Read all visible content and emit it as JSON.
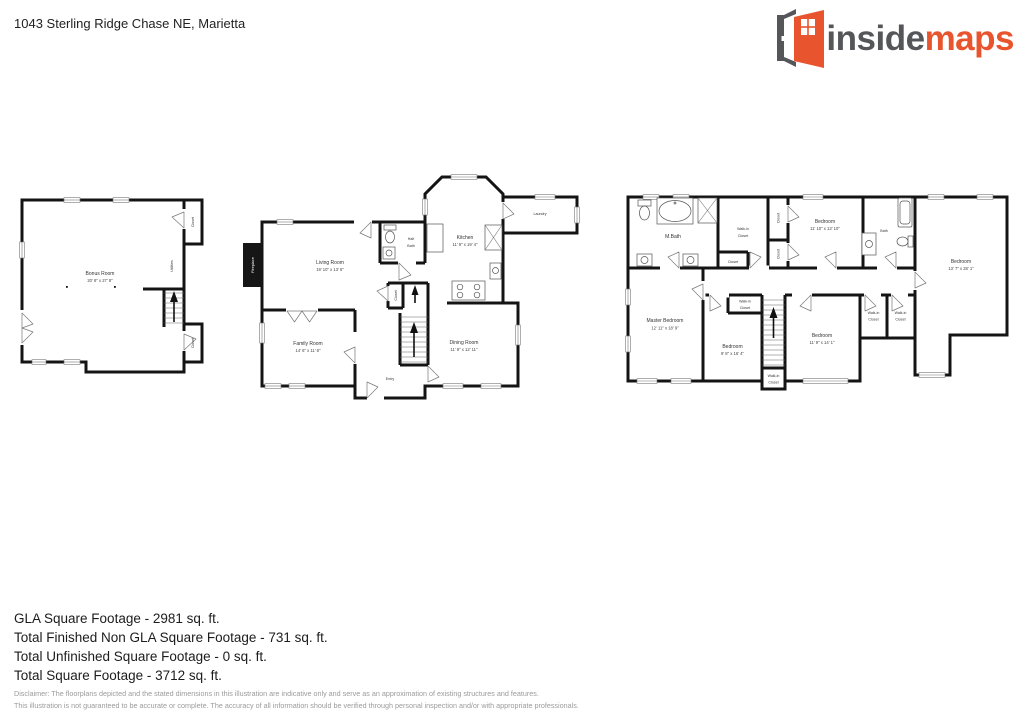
{
  "header": {
    "address": "1043 Sterling Ridge Chase NE, Marietta"
  },
  "logo": {
    "word_dark": "inside",
    "word_accent": "maps",
    "accent_color": "#e8542e",
    "dark_color": "#55565a"
  },
  "shared": {
    "closet": "Closet",
    "walk_in_line1": "Walk-in",
    "walk_in_line2": "Closet"
  },
  "floors": {
    "basement": {
      "bonus_room": {
        "name": "Bonus Room",
        "dims": "20' 8\" x 27' 8\""
      },
      "utilities": "Utilities"
    },
    "main": {
      "living_room": {
        "name": "Living Room",
        "dims": "19' 10\" x 13' 6\""
      },
      "kitchen": {
        "name": "Kitchen",
        "dims": "11' 9\" x 19' 4\""
      },
      "family_room": {
        "name": "Family Room",
        "dims": "14' 6\" x 11' 8\""
      },
      "dining_room": {
        "name": "Dining Room",
        "dims": "11' 9\" x 12' 11\""
      },
      "half_bath_line1": "Half",
      "half_bath_line2": "Bath",
      "laundry": "Laundry",
      "entry": "Entry",
      "fireplace": "Fireplace"
    },
    "upper": {
      "master_bedroom": {
        "name": "Master Bedroom",
        "dims": "12' 11\" x 18' 9\""
      },
      "m_bath": "M.Bath",
      "bath": "Bath",
      "bedroom_top": {
        "name": "Bedroom",
        "dims": "11' 10\" x 13' 10\""
      },
      "bedroom_right": {
        "name": "Bedroom",
        "dims": "13' 7\" x 28' 1\""
      },
      "bedroom_center": {
        "name": "Bedroom",
        "dims": "9' 8\" x 16' 4\""
      },
      "bedroom_bottom": {
        "name": "Bedroom",
        "dims": "11' 9\" x 14' 1\""
      }
    }
  },
  "summary": {
    "lines": [
      "GLA Square Footage - 2981 sq. ft.",
      "Total Finished Non GLA Square Footage - 731 sq. ft.",
      "Total Unfinished Square Footage - 0 sq. ft.",
      "Total Square Footage - 3712 sq. ft."
    ]
  },
  "disclaimer": {
    "line1": "Disclaimer: The floorplans depicted and the stated dimensions in this illustration are indicative only and serve as an approximation of existing structures and features.",
    "line2": "This illustration is not guaranteed to be accurate or complete. The accuracy of all information should be verified through personal inspection and/or with appropriate professionals."
  }
}
